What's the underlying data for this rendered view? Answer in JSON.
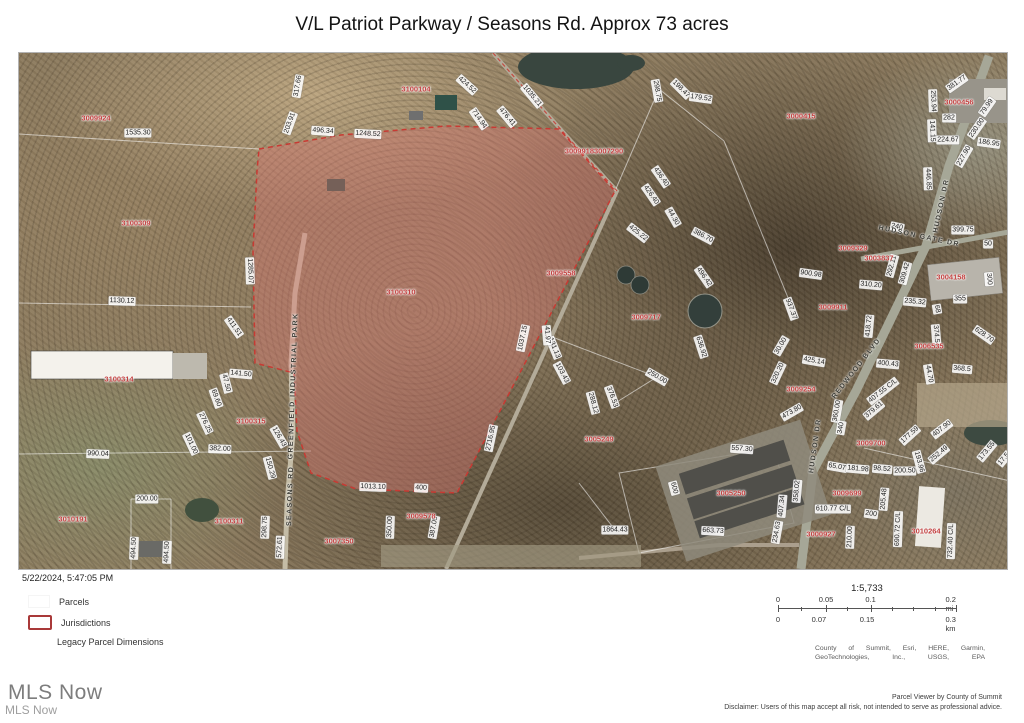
{
  "page": {
    "title": "V/L Patriot Parkway / Seasons Rd. Approx 73 acres"
  },
  "footer": {
    "timestamp": "5/22/2024, 5:47:05 PM",
    "legend": {
      "items": [
        {
          "label": "Parcels"
        },
        {
          "label": "Jurisdictions"
        },
        {
          "label": "Legacy Parcel Dimensions"
        }
      ]
    },
    "scale": {
      "ratio": "1:5,733",
      "mi_labels": [
        "0",
        "0.05",
        "0.1",
        "0.2 mi"
      ],
      "km_labels": [
        "0",
        "0.07",
        "0.15",
        "0.3 km"
      ]
    },
    "attribution_line1": "County of Summit, Esri, HERE, Garmin,",
    "attribution_line2": "GeoTechnologies, Inc., USGS, EPA",
    "viewer_credit": "Parcel Viewer by County of Summit",
    "disclaimer": "Disclaimer: Users of this map accept all risk, not intended to serve as professional advice.",
    "watermark_large": "MLS Now",
    "watermark_small": "MLS Now"
  },
  "map": {
    "highlight_color": "#c83a33",
    "parcel_labels": [
      {
        "t": "3009924",
        "x": 77,
        "y": 65
      },
      {
        "t": "3100309",
        "x": 117,
        "y": 170
      },
      {
        "t": "3100104",
        "x": 397,
        "y": 36
      },
      {
        "t": "30099183007290",
        "x": 575,
        "y": 98
      },
      {
        "t": "3000415",
        "x": 782,
        "y": 63
      },
      {
        "t": "3000456",
        "x": 940,
        "y": 49
      },
      {
        "t": "3009329",
        "x": 834,
        "y": 195
      },
      {
        "t": "3003837",
        "x": 860,
        "y": 205
      },
      {
        "t": "3004158",
        "x": 932,
        "y": 224
      },
      {
        "t": "3009911",
        "x": 814,
        "y": 254
      },
      {
        "t": "3009558",
        "x": 542,
        "y": 220
      },
      {
        "t": "3009717",
        "x": 627,
        "y": 264
      },
      {
        "t": "3100310",
        "x": 382,
        "y": 239
      },
      {
        "t": "3100314",
        "x": 100,
        "y": 326
      },
      {
        "t": "3100315",
        "x": 232,
        "y": 368
      },
      {
        "t": "3009254",
        "x": 782,
        "y": 336
      },
      {
        "t": "3006535",
        "x": 910,
        "y": 293
      },
      {
        "t": "3005249",
        "x": 580,
        "y": 386
      },
      {
        "t": "3009700",
        "x": 852,
        "y": 390
      },
      {
        "t": "3009699",
        "x": 828,
        "y": 440
      },
      {
        "t": "3005250",
        "x": 712,
        "y": 440
      },
      {
        "t": "3010191",
        "x": 54,
        "y": 466
      },
      {
        "t": "3100311",
        "x": 210,
        "y": 468
      },
      {
        "t": "3007350",
        "x": 320,
        "y": 488
      },
      {
        "t": "3009578",
        "x": 402,
        "y": 463
      },
      {
        "t": "3000927",
        "x": 802,
        "y": 481
      },
      {
        "t": "3010264",
        "x": 907,
        "y": 478
      }
    ],
    "dimension_labels": [
      {
        "t": "1535.30",
        "x": 119,
        "y": 80,
        "r": 0
      },
      {
        "t": "317.66",
        "x": 279,
        "y": 33,
        "r": -80
      },
      {
        "t": "203.91",
        "x": 271,
        "y": 70,
        "r": -70
      },
      {
        "t": "496.34",
        "x": 304,
        "y": 78,
        "r": 4
      },
      {
        "t": "1248.52",
        "x": 349,
        "y": 81,
        "r": 3
      },
      {
        "t": "424.52",
        "x": 448,
        "y": 32,
        "r": 42
      },
      {
        "t": "1035.21",
        "x": 513,
        "y": 43,
        "r": 50
      },
      {
        "t": "714.94",
        "x": 460,
        "y": 66,
        "r": 55
      },
      {
        "t": "476.41",
        "x": 488,
        "y": 64,
        "r": 50
      },
      {
        "t": "298.75",
        "x": 638,
        "y": 38,
        "r": 80
      },
      {
        "t": "198.47",
        "x": 662,
        "y": 36,
        "r": 45
      },
      {
        "t": "179.52",
        "x": 682,
        "y": 45,
        "r": 8
      },
      {
        "t": "436.40",
        "x": 642,
        "y": 124,
        "r": 55
      },
      {
        "t": "426.40",
        "x": 632,
        "y": 142,
        "r": 55
      },
      {
        "t": "44.30",
        "x": 654,
        "y": 164,
        "r": 60
      },
      {
        "t": "425.22",
        "x": 619,
        "y": 180,
        "r": 38
      },
      {
        "t": "386.70",
        "x": 684,
        "y": 183,
        "r": 28
      },
      {
        "t": "496.42",
        "x": 685,
        "y": 224,
        "r": 55
      },
      {
        "t": "937.37",
        "x": 772,
        "y": 256,
        "r": 70
      },
      {
        "t": "636.92",
        "x": 682,
        "y": 294,
        "r": 72
      },
      {
        "t": "30.00",
        "x": 762,
        "y": 293,
        "r": -60
      },
      {
        "t": "320.20",
        "x": 759,
        "y": 320,
        "r": -65
      },
      {
        "t": "250.00",
        "x": 638,
        "y": 324,
        "r": 30
      },
      {
        "t": "376.53",
        "x": 593,
        "y": 344,
        "r": 70
      },
      {
        "t": "288.12",
        "x": 574,
        "y": 350,
        "r": 75
      },
      {
        "t": "131.13",
        "x": 535,
        "y": 295,
        "r": 68
      },
      {
        "t": "103.43",
        "x": 543,
        "y": 320,
        "r": 62
      },
      {
        "t": "41.97",
        "x": 528,
        "y": 282,
        "r": 85
      },
      {
        "t": "1037.15",
        "x": 504,
        "y": 285,
        "r": -78
      },
      {
        "t": "2716.95",
        "x": 472,
        "y": 385,
        "r": -78
      },
      {
        "t": "381.77",
        "x": 938,
        "y": 30,
        "r": -35
      },
      {
        "t": "253.94",
        "x": 914,
        "y": 48,
        "r": 88
      },
      {
        "t": "282",
        "x": 930,
        "y": 65,
        "r": 0
      },
      {
        "t": "79.99",
        "x": 968,
        "y": 54,
        "r": -55
      },
      {
        "t": "230.00",
        "x": 958,
        "y": 75,
        "r": -55
      },
      {
        "t": "141.15",
        "x": 913,
        "y": 78,
        "r": 88
      },
      {
        "t": "224.67",
        "x": 929,
        "y": 87,
        "r": 0
      },
      {
        "t": "186.95",
        "x": 970,
        "y": 90,
        "r": 8
      },
      {
        "t": "227.90",
        "x": 945,
        "y": 103,
        "r": -60
      },
      {
        "t": "446.85",
        "x": 909,
        "y": 126,
        "r": 88
      },
      {
        "t": "240",
        "x": 878,
        "y": 174,
        "r": 12
      },
      {
        "t": "399.75",
        "x": 944,
        "y": 177,
        "r": 0
      },
      {
        "t": "50",
        "x": 969,
        "y": 191,
        "r": 0
      },
      {
        "t": "900.98",
        "x": 792,
        "y": 221,
        "r": 8
      },
      {
        "t": "310.20",
        "x": 852,
        "y": 232,
        "r": 5
      },
      {
        "t": "292.11",
        "x": 873,
        "y": 213,
        "r": -75
      },
      {
        "t": "309.42",
        "x": 886,
        "y": 220,
        "r": -75
      },
      {
        "t": "300",
        "x": 970,
        "y": 226,
        "r": 85
      },
      {
        "t": "235.32",
        "x": 896,
        "y": 249,
        "r": 5
      },
      {
        "t": "355",
        "x": 941,
        "y": 246,
        "r": 0
      },
      {
        "t": "68",
        "x": 918,
        "y": 256,
        "r": 80
      },
      {
        "t": "418.72",
        "x": 850,
        "y": 273,
        "r": -85
      },
      {
        "t": "374.5",
        "x": 917,
        "y": 281,
        "r": 85
      },
      {
        "t": "628.70",
        "x": 965,
        "y": 282,
        "r": 35
      },
      {
        "t": "425.14",
        "x": 795,
        "y": 308,
        "r": 10
      },
      {
        "t": "400.43",
        "x": 869,
        "y": 311,
        "r": 5
      },
      {
        "t": "44.70",
        "x": 910,
        "y": 321,
        "r": 80
      },
      {
        "t": "368.5",
        "x": 943,
        "y": 316,
        "r": 5
      },
      {
        "t": "407.55 C/L",
        "x": 864,
        "y": 338,
        "r": -38
      },
      {
        "t": "379.61",
        "x": 855,
        "y": 357,
        "r": -40
      },
      {
        "t": "177.59",
        "x": 891,
        "y": 382,
        "r": -42
      },
      {
        "t": "407.90",
        "x": 923,
        "y": 376,
        "r": -38
      },
      {
        "t": "252.49",
        "x": 920,
        "y": 401,
        "r": -40
      },
      {
        "t": "173.55",
        "x": 968,
        "y": 398,
        "r": -50
      },
      {
        "t": "17.5",
        "x": 985,
        "y": 406,
        "r": -50
      },
      {
        "t": "98.52",
        "x": 863,
        "y": 416,
        "r": 5
      },
      {
        "t": "200.50",
        "x": 886,
        "y": 418,
        "r": 0
      },
      {
        "t": "193.96",
        "x": 900,
        "y": 409,
        "r": 75
      },
      {
        "t": "65.07",
        "x": 818,
        "y": 414,
        "r": 10
      },
      {
        "t": "181.98",
        "x": 839,
        "y": 416,
        "r": 5
      },
      {
        "t": "610.77 C/L",
        "x": 814,
        "y": 456,
        "r": 0
      },
      {
        "t": "205.48",
        "x": 865,
        "y": 446,
        "r": -85
      },
      {
        "t": "200",
        "x": 852,
        "y": 461,
        "r": 8
      },
      {
        "t": "690.72 C/L",
        "x": 879,
        "y": 476,
        "r": -88
      },
      {
        "t": "732.40 C/L",
        "x": 932,
        "y": 488,
        "r": -88
      },
      {
        "t": "557.30",
        "x": 723,
        "y": 396,
        "r": 4
      },
      {
        "t": "600",
        "x": 655,
        "y": 435,
        "r": 75
      },
      {
        "t": "663.73",
        "x": 694,
        "y": 478,
        "r": 3
      },
      {
        "t": "1864.43",
        "x": 596,
        "y": 477,
        "r": 0
      },
      {
        "t": "234.63",
        "x": 758,
        "y": 479,
        "r": -80
      },
      {
        "t": "360.00",
        "x": 818,
        "y": 358,
        "r": -80
      },
      {
        "t": "340",
        "x": 822,
        "y": 375,
        "r": -80
      },
      {
        "t": "473.80",
        "x": 773,
        "y": 359,
        "r": -30
      },
      {
        "t": "358.02",
        "x": 778,
        "y": 438,
        "r": -85
      },
      {
        "t": "407.34",
        "x": 763,
        "y": 453,
        "r": -85
      },
      {
        "t": "210.00",
        "x": 831,
        "y": 484,
        "r": -88
      },
      {
        "t": "1130.12",
        "x": 103,
        "y": 248,
        "r": 2
      },
      {
        "t": "411.51",
        "x": 215,
        "y": 274,
        "r": 55
      },
      {
        "t": "141.50",
        "x": 222,
        "y": 321,
        "r": 5
      },
      {
        "t": "47.50",
        "x": 207,
        "y": 330,
        "r": 75
      },
      {
        "t": "69.60",
        "x": 197,
        "y": 345,
        "r": 70
      },
      {
        "t": "276.25",
        "x": 186,
        "y": 370,
        "r": 65
      },
      {
        "t": "1285.07",
        "x": 231,
        "y": 218,
        "r": 88
      },
      {
        "t": "990.04",
        "x": 79,
        "y": 401,
        "r": 2
      },
      {
        "t": "101.00",
        "x": 172,
        "y": 391,
        "r": 65
      },
      {
        "t": "382.00",
        "x": 201,
        "y": 396,
        "r": 2
      },
      {
        "t": "126.43",
        "x": 260,
        "y": 384,
        "r": 60
      },
      {
        "t": "150.29",
        "x": 251,
        "y": 415,
        "r": 75
      },
      {
        "t": "200.00",
        "x": 128,
        "y": 446,
        "r": 0
      },
      {
        "t": "494.50",
        "x": 115,
        "y": 495,
        "r": -88
      },
      {
        "t": "494.50",
        "x": 148,
        "y": 499,
        "r": -88
      },
      {
        "t": "298.75",
        "x": 246,
        "y": 474,
        "r": -88
      },
      {
        "t": "572.61",
        "x": 261,
        "y": 494,
        "r": -88
      },
      {
        "t": "1013.10",
        "x": 354,
        "y": 434,
        "r": 2
      },
      {
        "t": "400",
        "x": 402,
        "y": 435,
        "r": 3
      },
      {
        "t": "350.00",
        "x": 371,
        "y": 474,
        "r": -88
      },
      {
        "t": "387.05",
        "x": 415,
        "y": 474,
        "r": -80
      }
    ],
    "street_labels": [
      {
        "t": "HUDSON DR",
        "x": 923,
        "y": 153,
        "r": -78
      },
      {
        "t": "HUDSON GATE DR",
        "x": 900,
        "y": 184,
        "r": 12
      },
      {
        "t": "REDWOOD BLVD",
        "x": 838,
        "y": 316,
        "r": -52
      },
      {
        "t": "HUDSON DR",
        "x": 797,
        "y": 393,
        "r": -82
      },
      {
        "t": "SEASONS RD",
        "x": 272,
        "y": 443,
        "r": -88
      },
      {
        "t": "GREENFIELD INDUSTRIAL PARK",
        "x": 275,
        "y": 333,
        "r": -88
      }
    ]
  }
}
